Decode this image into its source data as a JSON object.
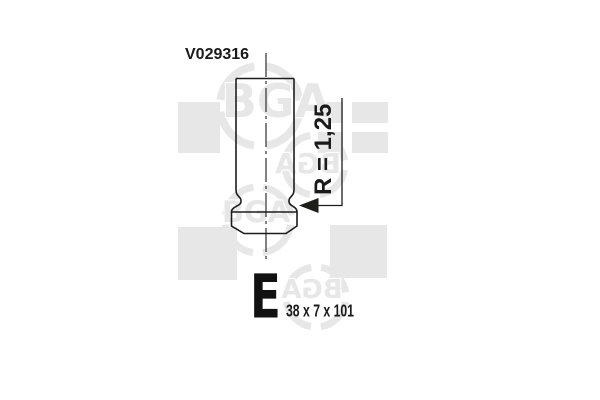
{
  "labels": {
    "part_number": "V029316",
    "radius": "R = 1,25",
    "valve_type_letter": "E",
    "dimensions": "38 x 7 x 101"
  },
  "watermark": {
    "brand": "BGA"
  },
  "colors": {
    "line": "#1d1d1b",
    "label_text": "#1a1a1a",
    "watermark_gray": "#e7e7e7",
    "background": "#ffffff"
  }
}
